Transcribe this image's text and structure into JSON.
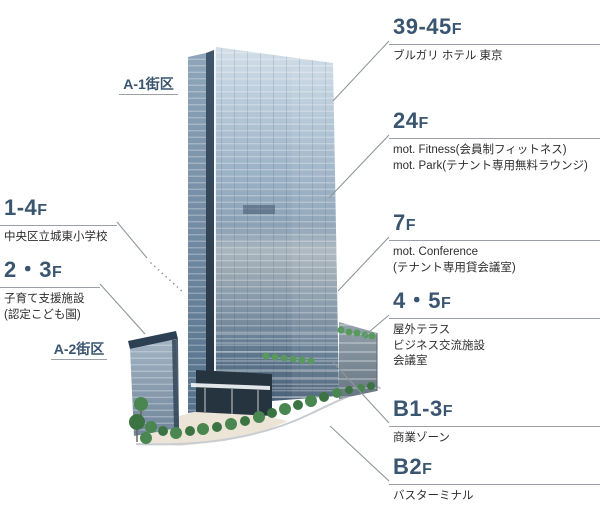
{
  "figure": {
    "type": "building-floor-guide-diagram",
    "background": "#ffffff"
  },
  "colors": {
    "accent_floor_number": "#3a5570",
    "description_text": "#2e2e2e",
    "leader_line": "#8f969c",
    "tower_glass_light": "#b9cbda",
    "tower_glass_dark": "#4a6076",
    "tree_green": "#4a8750"
  },
  "blocks": {
    "a1": {
      "label": "A-1街区"
    },
    "a2": {
      "label": "A-2街区"
    }
  },
  "left_labels": [
    {
      "floor": "1-4",
      "suffix": "F",
      "lines": [
        "中央区立城東小学校"
      ]
    },
    {
      "floor": "2・3",
      "suffix": "F",
      "lines": [
        "子育て支援施設",
        "(認定こども園)"
      ]
    }
  ],
  "right_labels": [
    {
      "floor": "39-45",
      "suffix": "F",
      "lines": [
        "ブルガリ ホテル 東京"
      ]
    },
    {
      "floor": "24",
      "suffix": "F",
      "lines": [
        "mot. Fitness(会員制フィットネス)",
        "mot. Park(テナント専用無料ラウンジ)"
      ]
    },
    {
      "floor": "7",
      "suffix": "F",
      "lines": [
        "mot. Conference",
        "(テナント専用貸会議室)"
      ]
    },
    {
      "floor": "4・5",
      "suffix": "F",
      "lines": [
        "屋外テラス",
        "ビジネス交流施設",
        "会議室"
      ]
    },
    {
      "floor": "B1-3",
      "suffix": "F",
      "lines": [
        "商業ゾーン"
      ]
    },
    {
      "floor": "B2",
      "suffix": "F",
      "lines": [
        "バスターミナル"
      ]
    }
  ]
}
